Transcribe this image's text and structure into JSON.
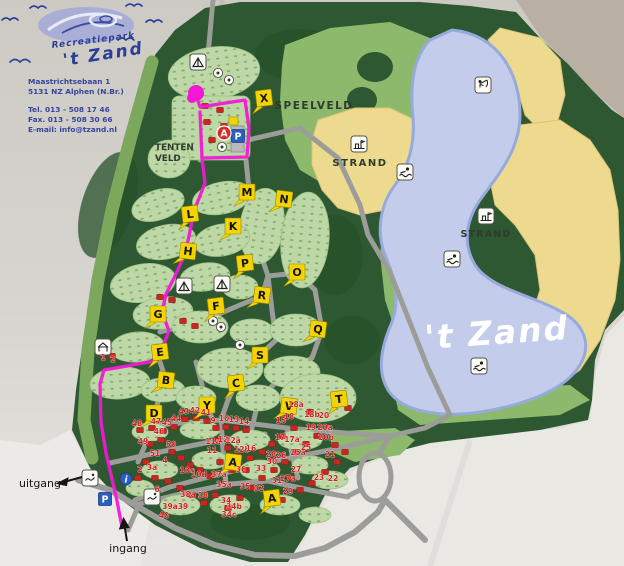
{
  "brand": {
    "park_type": "Recreatiepark",
    "park_name": "'t Zand",
    "address_line1": "Maastrichtsebaan 1",
    "address_line2": "5131 NZ  Alphen (N.Br.)",
    "tel": "Tel. 013 - 508 17 46",
    "fax": "Fax. 013 - 508 30 66",
    "email": "E-mail: info@tzand.nl"
  },
  "map": {
    "labels": {
      "playfield": "SPEELVELD",
      "beach_west": "STRAND",
      "beach_east": "STRAND",
      "tentfield_line1": "TENTEN",
      "tentfield_line2": "VELD",
      "lake_name": "'t Zand",
      "exit": "uitgang",
      "entrance": "ingang"
    },
    "colors": {
      "paper": "#d5d2cd",
      "forest": "#2d5831",
      "meadow": "#8cb96c",
      "camp": "#bdd8a6",
      "sand": "#eeda8e",
      "lake": "#c3cdeb",
      "lake_border": "#97aadc",
      "road": "#9c9c98",
      "route": "#f318d8",
      "marker_yellow": "#f3d402",
      "number_red": "#d31e1e",
      "parking_blue": "#2a5fc0",
      "reception_red": "#d32b23"
    },
    "you_are_here": {
      "x": 196,
      "y": 93
    },
    "route": {
      "path": "M196,95 L200,107 L245,100 L249,128 L247,157 L202,158 L200,112 M202,158 L205,183 L194,211 L189,236 L185,254 L175,276 L166,294 L162,312 L169,331 L161,351 L155,361 L104,370 L100,384 L101,422 L106,453 L112,479 L117,501 L122,527"
    },
    "letter_markers": [
      {
        "letter": "X",
        "x": 264,
        "y": 98
      },
      {
        "letter": "M",
        "x": 247,
        "y": 192
      },
      {
        "letter": "N",
        "x": 284,
        "y": 199
      },
      {
        "letter": "L",
        "x": 190,
        "y": 214
      },
      {
        "letter": "K",
        "x": 233,
        "y": 226
      },
      {
        "letter": "H",
        "x": 188,
        "y": 251
      },
      {
        "letter": "P",
        "x": 245,
        "y": 263
      },
      {
        "letter": "O",
        "x": 297,
        "y": 272
      },
      {
        "letter": "R",
        "x": 262,
        "y": 295
      },
      {
        "letter": "F",
        "x": 216,
        "y": 306
      },
      {
        "letter": "G",
        "x": 158,
        "y": 314
      },
      {
        "letter": "Q",
        "x": 318,
        "y": 329
      },
      {
        "letter": "E",
        "x": 160,
        "y": 352
      },
      {
        "letter": "S",
        "x": 260,
        "y": 355
      },
      {
        "letter": "B",
        "x": 166,
        "y": 380
      },
      {
        "letter": "C",
        "x": 236,
        "y": 383
      },
      {
        "letter": "Y",
        "x": 207,
        "y": 405
      },
      {
        "letter": "V",
        "x": 289,
        "y": 406
      },
      {
        "letter": "T",
        "x": 339,
        "y": 399
      },
      {
        "letter": "D",
        "x": 154,
        "y": 413
      },
      {
        "letter": "A",
        "x": 233,
        "y": 462
      },
      {
        "letter": "A",
        "x": 272,
        "y": 498
      }
    ],
    "site_numbers": [
      {
        "n": "48",
        "x": 137,
        "y": 426
      },
      {
        "n": "47",
        "x": 156,
        "y": 424
      },
      {
        "n": "46",
        "x": 159,
        "y": 434
      },
      {
        "n": "45",
        "x": 167,
        "y": 425
      },
      {
        "n": "44",
        "x": 176,
        "y": 421
      },
      {
        "n": "43",
        "x": 184,
        "y": 414
      },
      {
        "n": "42",
        "x": 195,
        "y": 413
      },
      {
        "n": "41",
        "x": 206,
        "y": 415
      },
      {
        "n": "49",
        "x": 143,
        "y": 444
      },
      {
        "n": "50",
        "x": 171,
        "y": 447
      },
      {
        "n": "51",
        "x": 155,
        "y": 456
      },
      {
        "n": "9",
        "x": 213,
        "y": 423
      },
      {
        "n": "10",
        "x": 224,
        "y": 421
      },
      {
        "n": "13",
        "x": 234,
        "y": 422
      },
      {
        "n": "14",
        "x": 244,
        "y": 424
      },
      {
        "n": "11a",
        "x": 213,
        "y": 444
      },
      {
        "n": "12",
        "x": 223,
        "y": 442
      },
      {
        "n": "12a",
        "x": 233,
        "y": 443
      },
      {
        "n": "11",
        "x": 212,
        "y": 453
      },
      {
        "n": "12b",
        "x": 242,
        "y": 452
      },
      {
        "n": "16",
        "x": 251,
        "y": 451
      },
      {
        "n": "15",
        "x": 281,
        "y": 423
      },
      {
        "n": "18",
        "x": 289,
        "y": 419
      },
      {
        "n": "17",
        "x": 280,
        "y": 440
      },
      {
        "n": "17a",
        "x": 292,
        "y": 442
      },
      {
        "n": "18a",
        "x": 296,
        "y": 407
      },
      {
        "n": "18b",
        "x": 312,
        "y": 417
      },
      {
        "n": "20",
        "x": 324,
        "y": 418
      },
      {
        "n": "19",
        "x": 311,
        "y": 430
      },
      {
        "n": "20a",
        "x": 325,
        "y": 430
      },
      {
        "n": "20b",
        "x": 326,
        "y": 440
      },
      {
        "n": "25",
        "x": 306,
        "y": 450
      },
      {
        "n": "25a",
        "x": 298,
        "y": 455
      },
      {
        "n": "28",
        "x": 271,
        "y": 457
      },
      {
        "n": "26",
        "x": 281,
        "y": 458
      },
      {
        "n": "30",
        "x": 272,
        "y": 464
      },
      {
        "n": "33",
        "x": 261,
        "y": 471
      },
      {
        "n": "27",
        "x": 296,
        "y": 472
      },
      {
        "n": "21",
        "x": 330,
        "y": 457
      },
      {
        "n": "23",
        "x": 319,
        "y": 480
      },
      {
        "n": "22",
        "x": 333,
        "y": 481
      },
      {
        "n": "31",
        "x": 277,
        "y": 483
      },
      {
        "n": "27a",
        "x": 288,
        "y": 481
      },
      {
        "n": "29",
        "x": 288,
        "y": 494
      },
      {
        "n": "32",
        "x": 259,
        "y": 491
      },
      {
        "n": "35",
        "x": 245,
        "y": 489
      },
      {
        "n": "36",
        "x": 241,
        "y": 472
      },
      {
        "n": "37a",
        "x": 219,
        "y": 477
      },
      {
        "n": "35a",
        "x": 224,
        "y": 487
      },
      {
        "n": "34",
        "x": 226,
        "y": 503
      },
      {
        "n": "34b",
        "x": 234,
        "y": 509
      },
      {
        "n": "34c",
        "x": 229,
        "y": 517
      },
      {
        "n": "38",
        "x": 203,
        "y": 498
      },
      {
        "n": "38a",
        "x": 188,
        "y": 497
      },
      {
        "n": "39a",
        "x": 170,
        "y": 509
      },
      {
        "n": "39",
        "x": 183,
        "y": 509
      },
      {
        "n": "40",
        "x": 164,
        "y": 518
      },
      {
        "n": "6",
        "x": 157,
        "y": 492
      },
      {
        "n": "2",
        "x": 140,
        "y": 472
      },
      {
        "n": "3a",
        "x": 152,
        "y": 470
      },
      {
        "n": "4",
        "x": 165,
        "y": 463
      },
      {
        "n": "10c",
        "x": 187,
        "y": 473
      },
      {
        "n": "10d",
        "x": 199,
        "y": 477
      },
      {
        "n": "1",
        "x": 103,
        "y": 360
      },
      {
        "n": "2",
        "x": 113,
        "y": 362
      }
    ],
    "amenity_icons": [
      {
        "type": "fishing",
        "x": 483,
        "y": 85
      },
      {
        "type": "swimming",
        "x": 405,
        "y": 172
      },
      {
        "type": "swimming",
        "x": 452,
        "y": 259
      },
      {
        "type": "swimming",
        "x": 479,
        "y": 366
      },
      {
        "type": "sandcastle",
        "x": 359,
        "y": 144
      },
      {
        "type": "sandcastle",
        "x": 486,
        "y": 216
      },
      {
        "type": "tent",
        "x": 198,
        "y": 62
      },
      {
        "type": "tent",
        "x": 184,
        "y": 286
      },
      {
        "type": "tent",
        "x": 222,
        "y": 284
      },
      {
        "type": "house",
        "x": 103,
        "y": 347
      },
      {
        "type": "board",
        "x": 90,
        "y": 478
      },
      {
        "type": "board",
        "x": 152,
        "y": 497
      },
      {
        "type": "parking",
        "x": 238,
        "y": 136
      },
      {
        "type": "parking",
        "x": 105,
        "y": 499
      },
      {
        "type": "info",
        "x": 126,
        "y": 479
      },
      {
        "type": "reception",
        "x": 224,
        "y": 133
      },
      {
        "type": "dot",
        "x": 218,
        "y": 73
      },
      {
        "type": "dot",
        "x": 229,
        "y": 80
      },
      {
        "type": "dot",
        "x": 222,
        "y": 147
      },
      {
        "type": "dot",
        "x": 213,
        "y": 321
      },
      {
        "type": "dot",
        "x": 221,
        "y": 327
      },
      {
        "type": "dot",
        "x": 240,
        "y": 345
      }
    ],
    "houses": [
      [
        205,
        106
      ],
      [
        220,
        110
      ],
      [
        207,
        122
      ],
      [
        224,
        126
      ],
      [
        212,
        140
      ],
      [
        160,
        297
      ],
      [
        172,
        300
      ],
      [
        183,
        321
      ],
      [
        195,
        326
      ],
      [
        102,
        354
      ],
      [
        112,
        356
      ],
      [
        140,
        430
      ],
      [
        152,
        428
      ],
      [
        163,
        431
      ],
      [
        174,
        427
      ],
      [
        185,
        419
      ],
      [
        196,
        418
      ],
      [
        207,
        421
      ],
      [
        216,
        428
      ],
      [
        226,
        427
      ],
      [
        236,
        428
      ],
      [
        246,
        430
      ],
      [
        150,
        444
      ],
      [
        161,
        440
      ],
      [
        172,
        452
      ],
      [
        181,
        458
      ],
      [
        190,
        465
      ],
      [
        200,
        470
      ],
      [
        210,
        476
      ],
      [
        146,
        462
      ],
      [
        138,
        478
      ],
      [
        155,
        478
      ],
      [
        168,
        481
      ],
      [
        180,
        488
      ],
      [
        192,
        495
      ],
      [
        204,
        503
      ],
      [
        215,
        495
      ],
      [
        228,
        508
      ],
      [
        240,
        498
      ],
      [
        252,
        488
      ],
      [
        262,
        478
      ],
      [
        274,
        470
      ],
      [
        285,
        462
      ],
      [
        296,
        452
      ],
      [
        306,
        444
      ],
      [
        317,
        436
      ],
      [
        290,
        478
      ],
      [
        300,
        490
      ],
      [
        312,
        483
      ],
      [
        325,
        472
      ],
      [
        337,
        462
      ],
      [
        218,
        440
      ],
      [
        228,
        448
      ],
      [
        238,
        456
      ],
      [
        250,
        458
      ],
      [
        262,
        452
      ],
      [
        272,
        444
      ],
      [
        282,
        436
      ],
      [
        294,
        428
      ],
      [
        270,
        493
      ],
      [
        282,
        500
      ],
      [
        246,
        470
      ],
      [
        232,
        470
      ],
      [
        220,
        462
      ],
      [
        335,
        445
      ],
      [
        345,
        452
      ],
      [
        348,
        408
      ],
      [
        310,
        412
      ]
    ]
  }
}
